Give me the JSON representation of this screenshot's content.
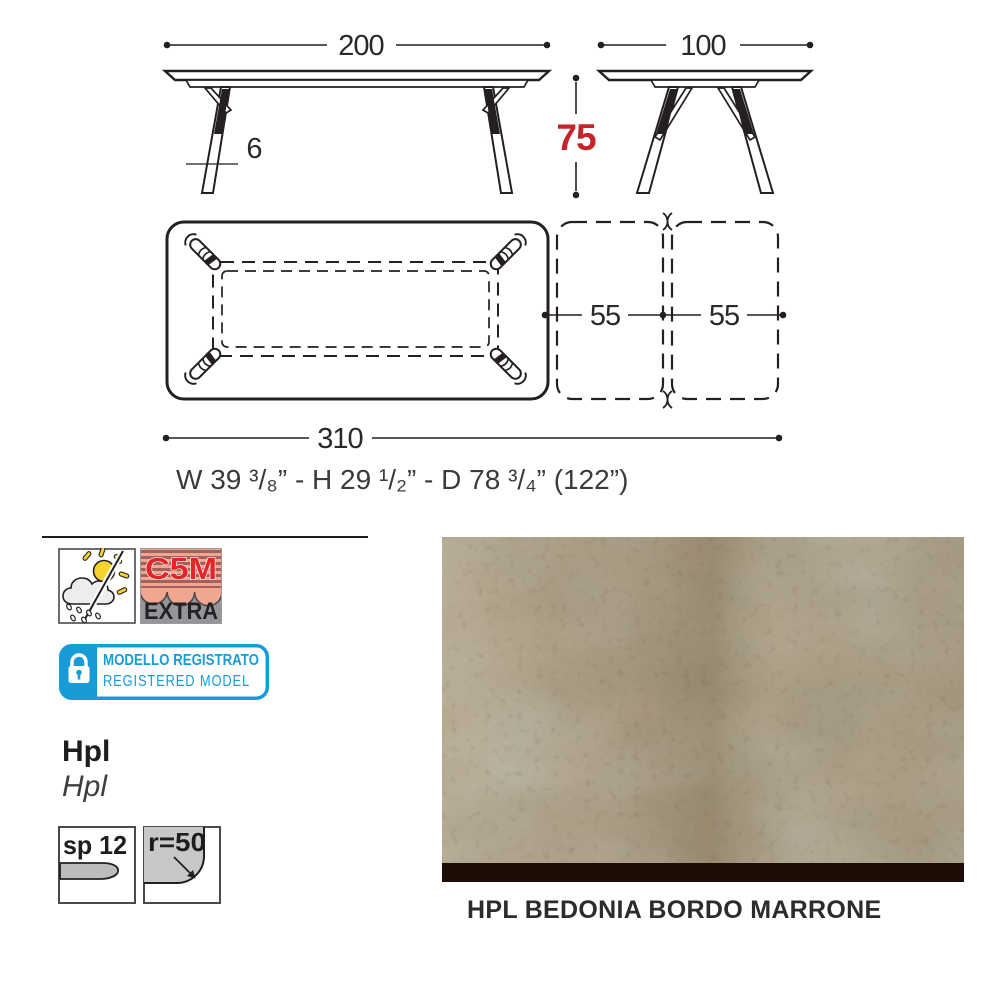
{
  "drawing": {
    "length_label": "200",
    "depth_label": "100",
    "height_label": "75",
    "thickness_label": "6",
    "ext1_label": "55",
    "ext2_label": "55",
    "total_label": "310",
    "imperial_label": "W 39 ³/₈” - H 29 ¹/₂”  - D 78 ³/₄” (122”)"
  },
  "badges": {
    "weather_icon": "sun-and-rain-outdoor-icon",
    "c5m": {
      "code": "C5M",
      "extra": "EXTRA"
    },
    "registered": {
      "line1": "MODELLO REGISTRATO",
      "line2": "REGISTERED MODEL"
    }
  },
  "material": {
    "name_bold": "Hpl",
    "name_italic": "Hpl",
    "thickness": "sp 12",
    "radius": "r=50"
  },
  "finish": {
    "caption": "HPL BEDONIA BORDO MARRONE"
  },
  "colors": {
    "accent_red": "#c5242b",
    "badge_blue": "#189cd8",
    "drawing_line": "#241f21",
    "swatch_edge": "#1d0d06"
  }
}
